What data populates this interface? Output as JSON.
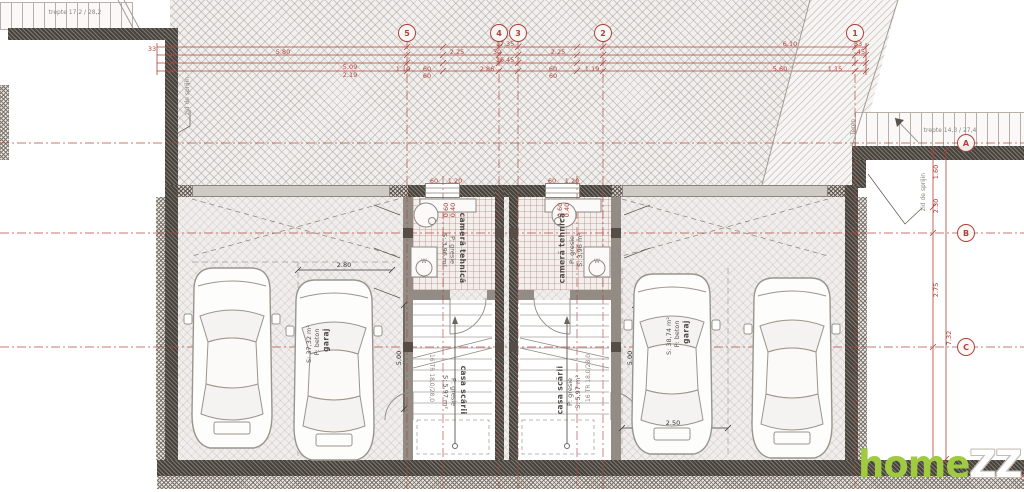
{
  "watermark": {
    "home": "home",
    "zz": "ZZ",
    "ro": ".ro"
  },
  "colors": {
    "dim_red": "#b0413a",
    "wall_dark": "#48423c",
    "watermark_green": "#9fca41",
    "watermark_red": "#e2574d"
  },
  "axes": [
    {
      "l": "5",
      "x": 407,
      "y": 33
    },
    {
      "l": "4",
      "x": 499,
      "y": 33
    },
    {
      "l": "3",
      "x": 518,
      "y": 33
    },
    {
      "l": "2",
      "x": 603,
      "y": 33
    },
    {
      "l": "1",
      "x": 855,
      "y": 33
    },
    {
      "l": "A",
      "x": 966,
      "y": 143
    },
    {
      "l": "B",
      "x": 966,
      "y": 233
    },
    {
      "l": "C",
      "x": 966,
      "y": 347
    }
  ],
  "annotations": [
    {
      "t": "17.35",
      "x": 505,
      "y": 44,
      "c": "red"
    },
    {
      "t": "6.10",
      "x": 790,
      "y": 44,
      "c": "red"
    },
    {
      "t": "33",
      "x": 858,
      "y": 44,
      "c": "red"
    },
    {
      "t": "5.80",
      "x": 283,
      "y": 52,
      "c": "red"
    },
    {
      "t": "2.25",
      "x": 457,
      "y": 52,
      "c": "red"
    },
    {
      "t": "30",
      "x": 497,
      "y": 52,
      "c": "red"
    },
    {
      "t": "2.25",
      "x": 558,
      "y": 52,
      "c": "red"
    },
    {
      "t": "45",
      "x": 861,
      "y": 52,
      "c": "red"
    },
    {
      "t": "16.45",
      "x": 505,
      "y": 60,
      "c": "red"
    },
    {
      "t": "33",
      "x": 152,
      "y": 49,
      "c": "red"
    },
    {
      "t": "5.09",
      "x": 350,
      "y": 67,
      "c": "red"
    },
    {
      "t": "2.19",
      "x": 350,
      "y": 75,
      "c": "red"
    },
    {
      "t": "1.10",
      "x": 403,
      "y": 69,
      "c": "red"
    },
    {
      "t": "60",
      "x": 427,
      "y": 69,
      "c": "red"
    },
    {
      "t": "60",
      "x": 427,
      "y": 76,
      "c": "red"
    },
    {
      "t": "2.86",
      "x": 487,
      "y": 69,
      "c": "red"
    },
    {
      "t": "60",
      "x": 553,
      "y": 69,
      "c": "red"
    },
    {
      "t": "60",
      "x": 553,
      "y": 76,
      "c": "red"
    },
    {
      "t": "1.19",
      "x": 592,
      "y": 69,
      "c": "red"
    },
    {
      "t": "5.60",
      "x": 780,
      "y": 69,
      "c": "red"
    },
    {
      "t": "1.15",
      "x": 835,
      "y": 69,
      "c": "red"
    },
    {
      "t": "60",
      "x": 434,
      "y": 181,
      "c": "red"
    },
    {
      "t": "1.20",
      "x": 455,
      "y": 181,
      "c": "red"
    },
    {
      "t": "60",
      "x": 552,
      "y": 181,
      "c": "red"
    },
    {
      "t": "1.20",
      "x": 572,
      "y": 181,
      "c": "red"
    },
    {
      "t": "0.60",
      "x": 446,
      "y": 210,
      "r": -90,
      "c": "red"
    },
    {
      "t": "0.40",
      "x": 453,
      "y": 210,
      "r": -90,
      "c": "red"
    },
    {
      "t": "0.60",
      "x": 560,
      "y": 210,
      "r": -90,
      "c": "red"
    },
    {
      "t": "0.40",
      "x": 567,
      "y": 210,
      "r": -90,
      "c": "red"
    },
    {
      "t": "1.60",
      "x": 936,
      "y": 172,
      "r": -90,
      "c": "red"
    },
    {
      "t": "2.30",
      "x": 936,
      "y": 206,
      "r": -90,
      "c": "red"
    },
    {
      "t": "2.75",
      "x": 936,
      "y": 290,
      "r": -90,
      "c": "red"
    },
    {
      "t": "7.32",
      "x": 949,
      "y": 338,
      "r": -90,
      "c": "red"
    },
    {
      "t": "2.80",
      "x": 344,
      "y": 265,
      "c": "blk"
    },
    {
      "t": "5.00",
      "x": 399,
      "y": 358,
      "r": -90,
      "c": "blk"
    },
    {
      "t": "5.00",
      "x": 630,
      "y": 358,
      "r": -90,
      "c": "blk"
    },
    {
      "t": "2.50",
      "x": 673,
      "y": 423,
      "c": "blk"
    },
    {
      "t": "trepte 17,2 / 28,2",
      "x": 75,
      "y": 13,
      "c": "gry"
    },
    {
      "t": "trepte 14,3 / 27,4",
      "x": 950,
      "y": 131,
      "c": "gry"
    },
    {
      "t": "zid de sprijin",
      "x": 188,
      "y": 96,
      "r": -90,
      "c": "gry",
      "n": "retaining-wall-label"
    },
    {
      "t": "zid de sprijin",
      "x": 924,
      "y": 192,
      "r": -90,
      "c": "gry",
      "n": "retaining-wall-label"
    },
    {
      "t": "Teren",
      "x": 854,
      "y": 127,
      "r": -90,
      "c": "gry",
      "n": "terrain-label"
    },
    {
      "t": "16 TR 18,0/28,0",
      "x": 431,
      "y": 378,
      "r": 90,
      "c": "gry",
      "n": "stair-treads-label"
    },
    {
      "t": "16 TR 18,0/28,0",
      "x": 589,
      "y": 378,
      "r": -90,
      "c": "gry",
      "n": "stair-treads-label"
    },
    {
      "t": "W",
      "x": 424,
      "y": 262,
      "c": "gry",
      "n": "washer-label"
    },
    {
      "t": "W",
      "x": 597,
      "y": 262,
      "c": "gry",
      "n": "washer-label"
    },
    {
      "t": "cameră tehnică",
      "x": 462,
      "y": 248,
      "r": 90,
      "c": "room",
      "n": "room-label"
    },
    {
      "t": "P: gresie",
      "x": 452,
      "y": 250,
      "r": 90,
      "c": "rooms",
      "n": "room-label"
    },
    {
      "t": "S: 3,96 m²",
      "x": 444,
      "y": 250,
      "r": 90,
      "c": "rooms",
      "n": "room-label"
    },
    {
      "t": "cameră tehnică",
      "x": 562,
      "y": 248,
      "r": -90,
      "c": "room",
      "n": "room-label"
    },
    {
      "t": "P: gresie",
      "x": 572,
      "y": 250,
      "r": -90,
      "c": "rooms",
      "n": "room-label"
    },
    {
      "t": "S: 3,96 m²",
      "x": 580,
      "y": 250,
      "r": -90,
      "c": "rooms",
      "n": "room-label"
    },
    {
      "t": "casa scării",
      "x": 463,
      "y": 390,
      "r": 90,
      "c": "room",
      "n": "room-label"
    },
    {
      "t": "P: gresie",
      "x": 453,
      "y": 392,
      "r": 90,
      "c": "rooms",
      "n": "room-label"
    },
    {
      "t": "S: 5,97 m²",
      "x": 445,
      "y": 392,
      "r": 90,
      "c": "rooms",
      "n": "room-label"
    },
    {
      "t": "casa scării",
      "x": 560,
      "y": 390,
      "r": -90,
      "c": "room",
      "n": "room-label"
    },
    {
      "t": "P: gresie",
      "x": 570,
      "y": 392,
      "r": -90,
      "c": "rooms",
      "n": "room-label"
    },
    {
      "t": "S: 5,97 m²",
      "x": 578,
      "y": 392,
      "r": -90,
      "c": "rooms",
      "n": "room-label"
    },
    {
      "t": "garaj",
      "x": 326,
      "y": 340,
      "r": -90,
      "c": "room",
      "n": "room-label"
    },
    {
      "t": "P: beton",
      "x": 317,
      "y": 342,
      "r": -90,
      "c": "rooms",
      "n": "room-label"
    },
    {
      "t": "S: 37,32 m²",
      "x": 309,
      "y": 344,
      "r": -90,
      "c": "rooms",
      "n": "room-label"
    },
    {
      "t": "garaj",
      "x": 686,
      "y": 332,
      "r": -90,
      "c": "room",
      "n": "room-label"
    },
    {
      "t": "P: beton",
      "x": 677,
      "y": 334,
      "r": -90,
      "c": "rooms",
      "n": "room-label"
    },
    {
      "t": "S: 38,74 m²",
      "x": 669,
      "y": 336,
      "r": -90,
      "c": "rooms",
      "n": "room-label"
    }
  ]
}
